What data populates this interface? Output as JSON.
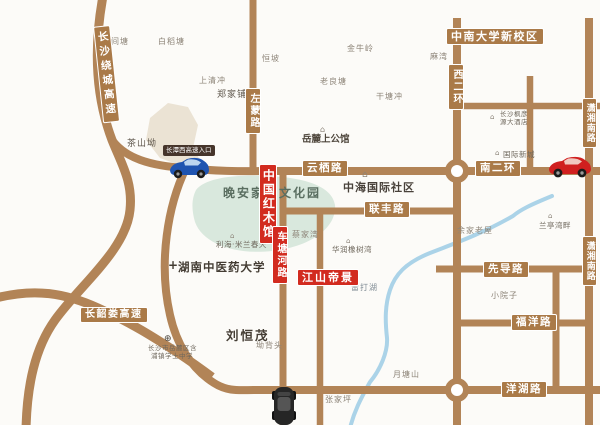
{
  "highlights": {
    "china_redwood_hall": "中国红木馆",
    "jiangshan_dijing": "江山帝景",
    "expressway_entrance": "长潭西高速入口",
    "wanan_home_culture_park": "晚安家居文化园",
    "csu_new_campus": "中南大学新校区"
  },
  "roads": {
    "changsha_ring_expwy": "长沙绕城高速",
    "changshaolou_expwy": "长韶娄高速",
    "zuomeng_rd": "左蒙路",
    "xi_2nd_ring": "西二环",
    "nan_2nd_ring": "南二环",
    "yunqi_rd": "云栖路",
    "lianfeng_rd": "联丰路",
    "chetanghe_rd": "车塘河路",
    "xiaoxiang_south_rd_north": "潇湘南路",
    "xiaoxiang_south_rd_south": "潇湘南路",
    "xiandao_rd": "先导路",
    "fuyang_rd": "福洋路",
    "yanghu_rd": "洋湖路"
  },
  "places": {
    "zhongjiantang": "中间塘",
    "baidaotang": "白稻塘",
    "shangqingchong": "上清冲",
    "hengpo": "恒坡",
    "zhengjiapuzi": "郑家铺子",
    "jinniuling": "金牛岭",
    "mawan": "麻湾",
    "laoliangtang": "老良塘",
    "gantangchong": "干塘冲",
    "chashanao": "茶山坳",
    "caijiawan": "蔡家湾",
    "leidahu": "雷打湖",
    "yujialaowu": "余家老屋",
    "xiaoyuanzi": "小院子",
    "yuetangshan": "月塘山",
    "zhangjiaping": "张家坪",
    "aobeitou": "坳背头",
    "liuhengmao": "刘恒茂"
  },
  "pois": {
    "yuelu_mansion": "岳麓上公馆",
    "zhonghai_intl_community": "中海国际社区",
    "intl_new_town": "国际新城",
    "hotel_line1": "长沙枫彦",
    "hotel_line2": "源大酒店",
    "huarun_oak_bay": "华润橡树湾",
    "lihai_milan_spring": "利海·米兰春天",
    "lanting_bay": "兰亭湾畔",
    "tcm_university": "湖南中医药大学",
    "school_line1": "长沙市岳麓区含",
    "school_line2": "浦镇学士中学"
  },
  "icons": {
    "building": "⌂",
    "hospital_cross": "+",
    "school": "⊕"
  },
  "colors": {
    "road": "#b28457",
    "road_label_bg": "#aa7a48",
    "highlight_red": "#d22b1f",
    "dark_label_bg": "#46352b",
    "lake_fill": "#d9e8dd",
    "hill_fill": "#ebe3d4",
    "river": "#abd3e8",
    "background": "#fcfbf8"
  }
}
